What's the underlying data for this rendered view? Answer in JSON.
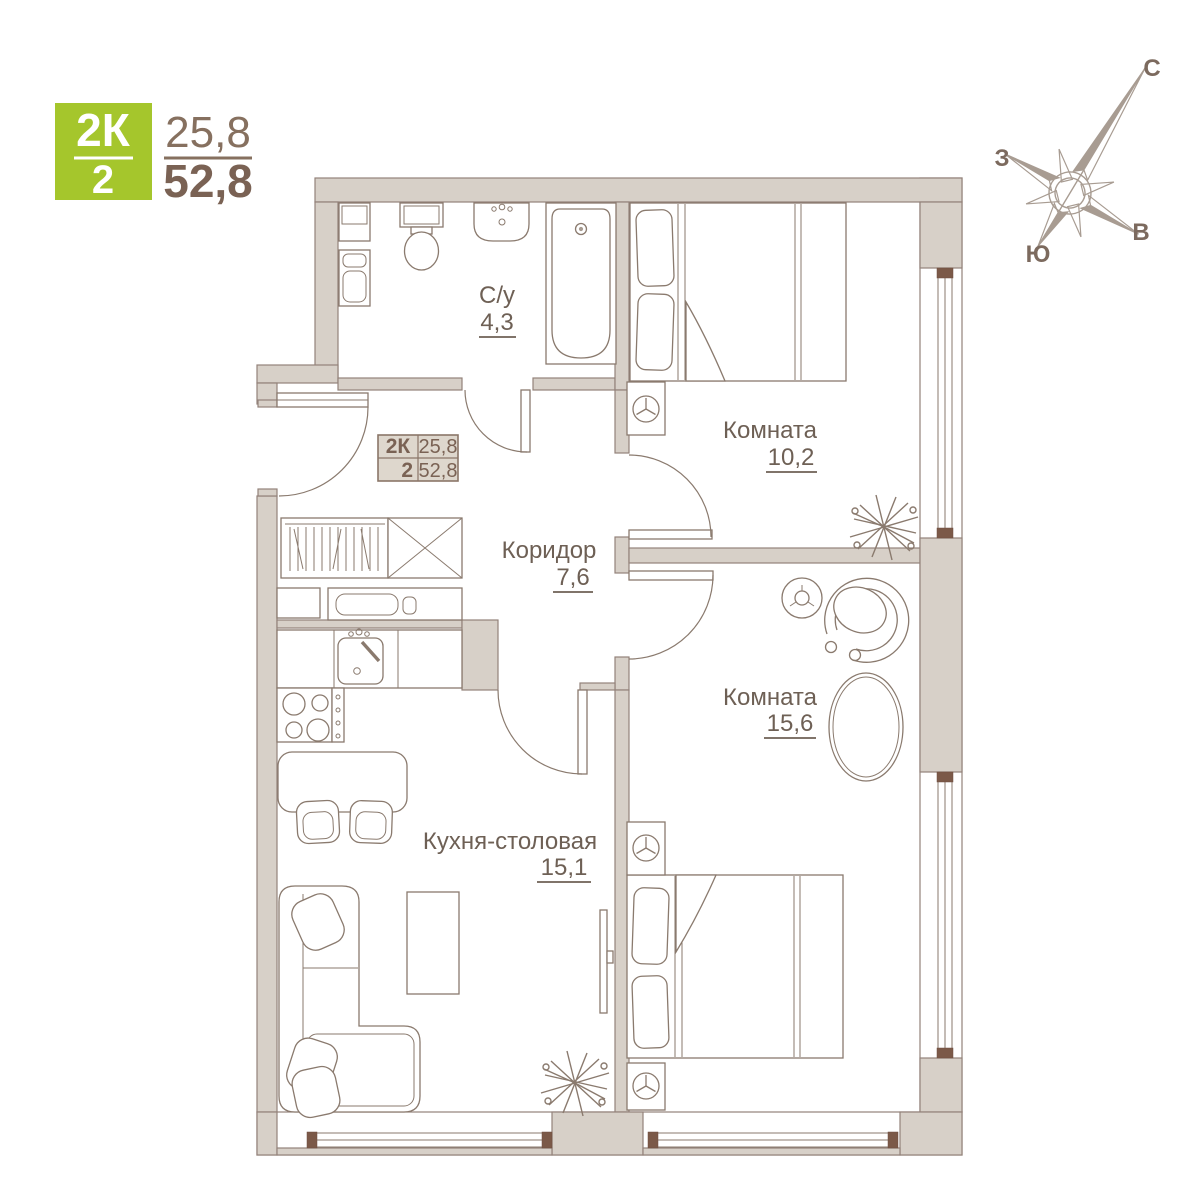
{
  "badge": {
    "type": "2К",
    "rooms": "2",
    "living_area": "25,8",
    "total_area": "52,8"
  },
  "plan_tag": {
    "type": "2К",
    "rooms": "2",
    "living_area": "25,8",
    "total_area": "52,8"
  },
  "rooms": {
    "bathroom": {
      "name": "С/у",
      "area": "4,3"
    },
    "bedroom_small": {
      "name": "Комната",
      "area": "10,2"
    },
    "corridor": {
      "name": "Коридор",
      "area": "7,6"
    },
    "bedroom_large": {
      "name": "Комната",
      "area": "15,6"
    },
    "kitchen_dining": {
      "name": "Кухня-столовая",
      "area": "15,1"
    }
  },
  "compass": {
    "north": "С",
    "south": "Ю",
    "west": "З",
    "east": "В"
  },
  "colors": {
    "accent_green": "#a5c62c",
    "wall_fill": "#d7d0c8",
    "line_brown": "#8a7a6e",
    "text_brown": "#6e6055",
    "window_cap": "#7b5948"
  }
}
